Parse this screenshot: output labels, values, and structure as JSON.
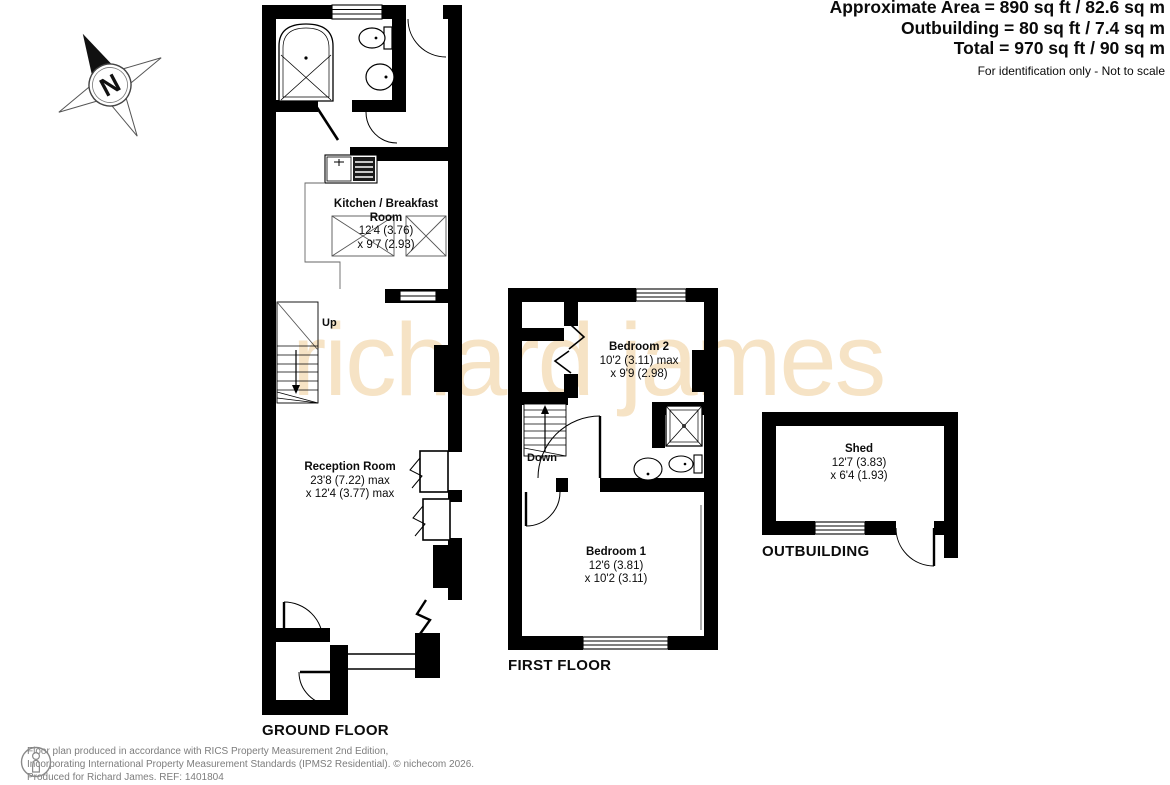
{
  "header": {
    "area_lines": [
      "Approximate Area = 890 sq ft / 82.6 sq m",
      "Outbuilding = 80 sq ft / 7.4 sq m",
      "Total = 970 sq ft / 90 sq m"
    ],
    "disclaimer": "For identification only - Not to scale"
  },
  "compass": {
    "north_label": "N"
  },
  "watermark": {
    "text": "richard james",
    "color": "#f6e3c5"
  },
  "ground_floor": {
    "label": "GROUND FLOOR",
    "stairs_label": "Up",
    "kitchen": {
      "name": "Kitchen / Breakfast Room",
      "dims": [
        "12'4 (3.76)",
        "x 9'7 (2.93)"
      ]
    },
    "reception": {
      "name": "Reception Room",
      "dims": [
        "23'8 (7.22) max",
        "x 12'4 (3.77) max"
      ]
    }
  },
  "first_floor": {
    "label": "FIRST FLOOR",
    "stairs_label": "Down",
    "bedroom2": {
      "name": "Bedroom 2",
      "dims": [
        "10'2 (3.11) max",
        "x 9'9 (2.98)"
      ]
    },
    "bedroom1": {
      "name": "Bedroom 1",
      "dims": [
        "12'6 (3.81)",
        "x 10'2 (3.11)"
      ]
    }
  },
  "outbuilding": {
    "label": "OUTBUILDING",
    "shed": {
      "name": "Shed",
      "dims": [
        "12'7 (3.83)",
        "x 6'4 (1.93)"
      ]
    }
  },
  "footer": {
    "lines": [
      "Floor plan produced in accordance with RICS Property Measurement 2nd Edition,",
      "Incorporating International Property Measurement Standards (IPMS2 Residential).  © nichecom 2026.",
      "Produced for Richard James.   REF:  1401804"
    ]
  }
}
